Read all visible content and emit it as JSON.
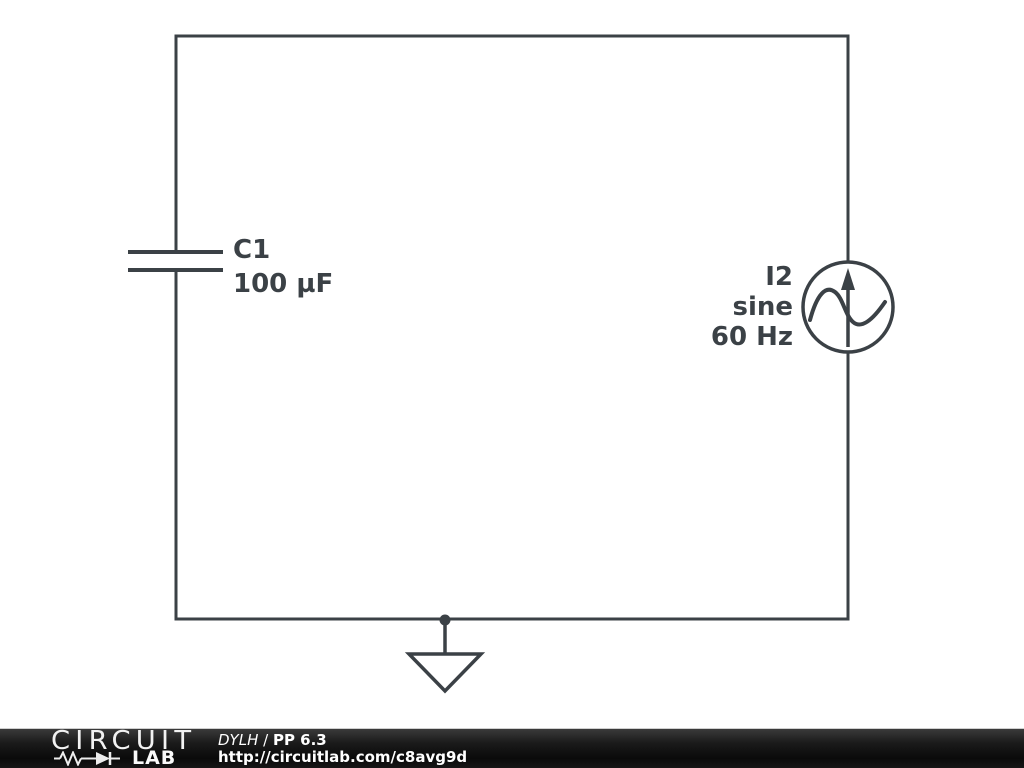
{
  "schematic": {
    "capacitor": {
      "ref": "C1",
      "value": "100 µF"
    },
    "current_source": {
      "ref": "I2",
      "waveform": "sine",
      "frequency": "60 Hz"
    },
    "icons": {
      "capacitor": "two-parallel-plates",
      "current_source": "circle-with-up-arrow-and-sine",
      "ground": "open-triangle-earth-ground",
      "logo_symbol": "resistor-zigzag-and-diode"
    },
    "colors": {
      "wire": "#3b4146",
      "background": "#ffffff"
    }
  },
  "footer": {
    "logo": {
      "line1": "CIRCUIT",
      "line2": "LAB"
    },
    "attribution": {
      "author": "DYLH",
      "separator": " / ",
      "title": "PP 6.3"
    },
    "url": "http://circuitlab.com/c8avg9d",
    "colors": {
      "background": "#111111",
      "text": "#ffffff"
    }
  }
}
